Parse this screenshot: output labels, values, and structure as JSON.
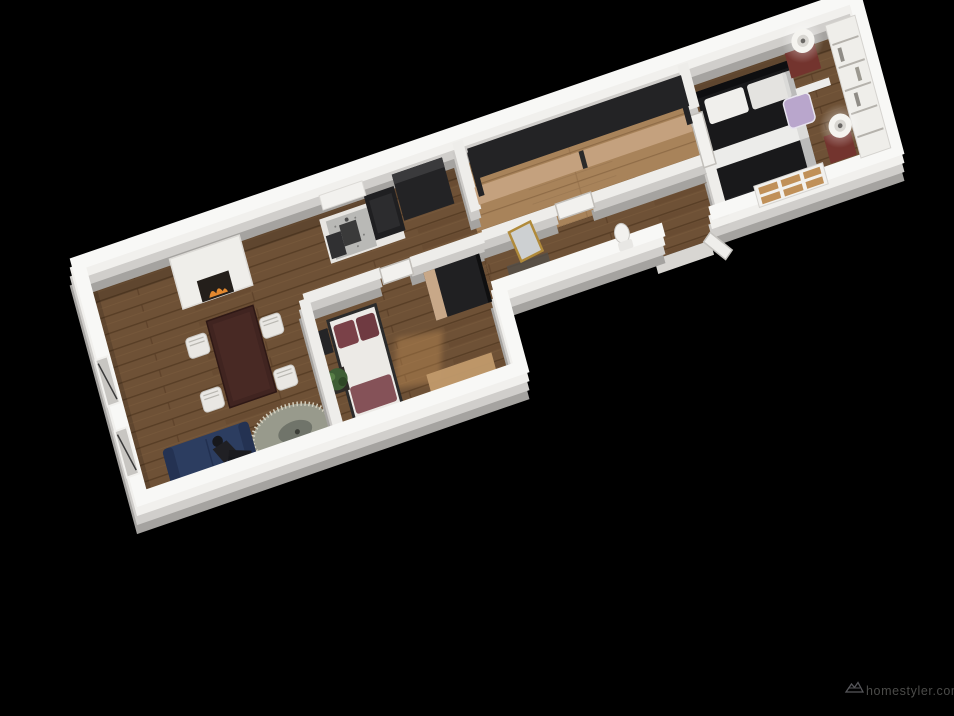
{
  "viewport": {
    "width": 954,
    "height": 716,
    "background": "#000000",
    "view": "3d-top-down-apartment-floorplan-render"
  },
  "watermark": {
    "icon": "homestyler-logo-icon",
    "text": "homestyler.com",
    "color": "#4b4b49"
  },
  "palette": {
    "wall_top": "#f1f0ed",
    "wall_face": "#d0cecb",
    "wall_shadow": "#aeaca9",
    "floor_wood": "#6e5136",
    "floor_wood_light": "#a8835a",
    "sofa_navy": "#2c3d60",
    "pillow_maroon": "#7a4148",
    "wardrobe_tan": "#c4a17e",
    "dark_furniture": "#1a1a1c",
    "flame_orange": "#e2882f",
    "mirror_gold": "#b08a3a",
    "stool_lavender": "#b9a6cc"
  },
  "rooms": [
    {
      "id": "living-room",
      "furniture": [
        "fireplace-with-flame",
        "dining-table-dark",
        "four-white-chairs",
        "navy-sofa",
        "person-figure",
        "oval-fringe-rug",
        "two-wall-windows"
      ]
    },
    {
      "id": "kitchen",
      "furniture": [
        "white-counter",
        "speckled-sink-top",
        "dark-cooktop",
        "tall-dark-fridge-cabinet",
        "wall-shelf",
        "small-appliance"
      ]
    },
    {
      "id": "small-bedroom",
      "furniture": [
        "white-bed-maroon-pillows",
        "black-side-table",
        "potted-plant",
        "dark-wardrobe",
        "sisal-mat",
        "white-door",
        "sunlight-patch"
      ]
    },
    {
      "id": "closet-room",
      "furniture": [
        "sliding-wardrobe-tan-doors",
        "gold-floor-mirror",
        "white-door"
      ]
    },
    {
      "id": "hallway",
      "furniture": [
        "toilet",
        "open-entry-door",
        "threshold"
      ]
    },
    {
      "id": "master-bedroom",
      "furniture": [
        "dark-double-bed-white-stripes",
        "two-lamps-on-red-nightstands",
        "white-bookshelf",
        "ladder-pane-rack",
        "lavender-stool",
        "white-door"
      ]
    }
  ]
}
